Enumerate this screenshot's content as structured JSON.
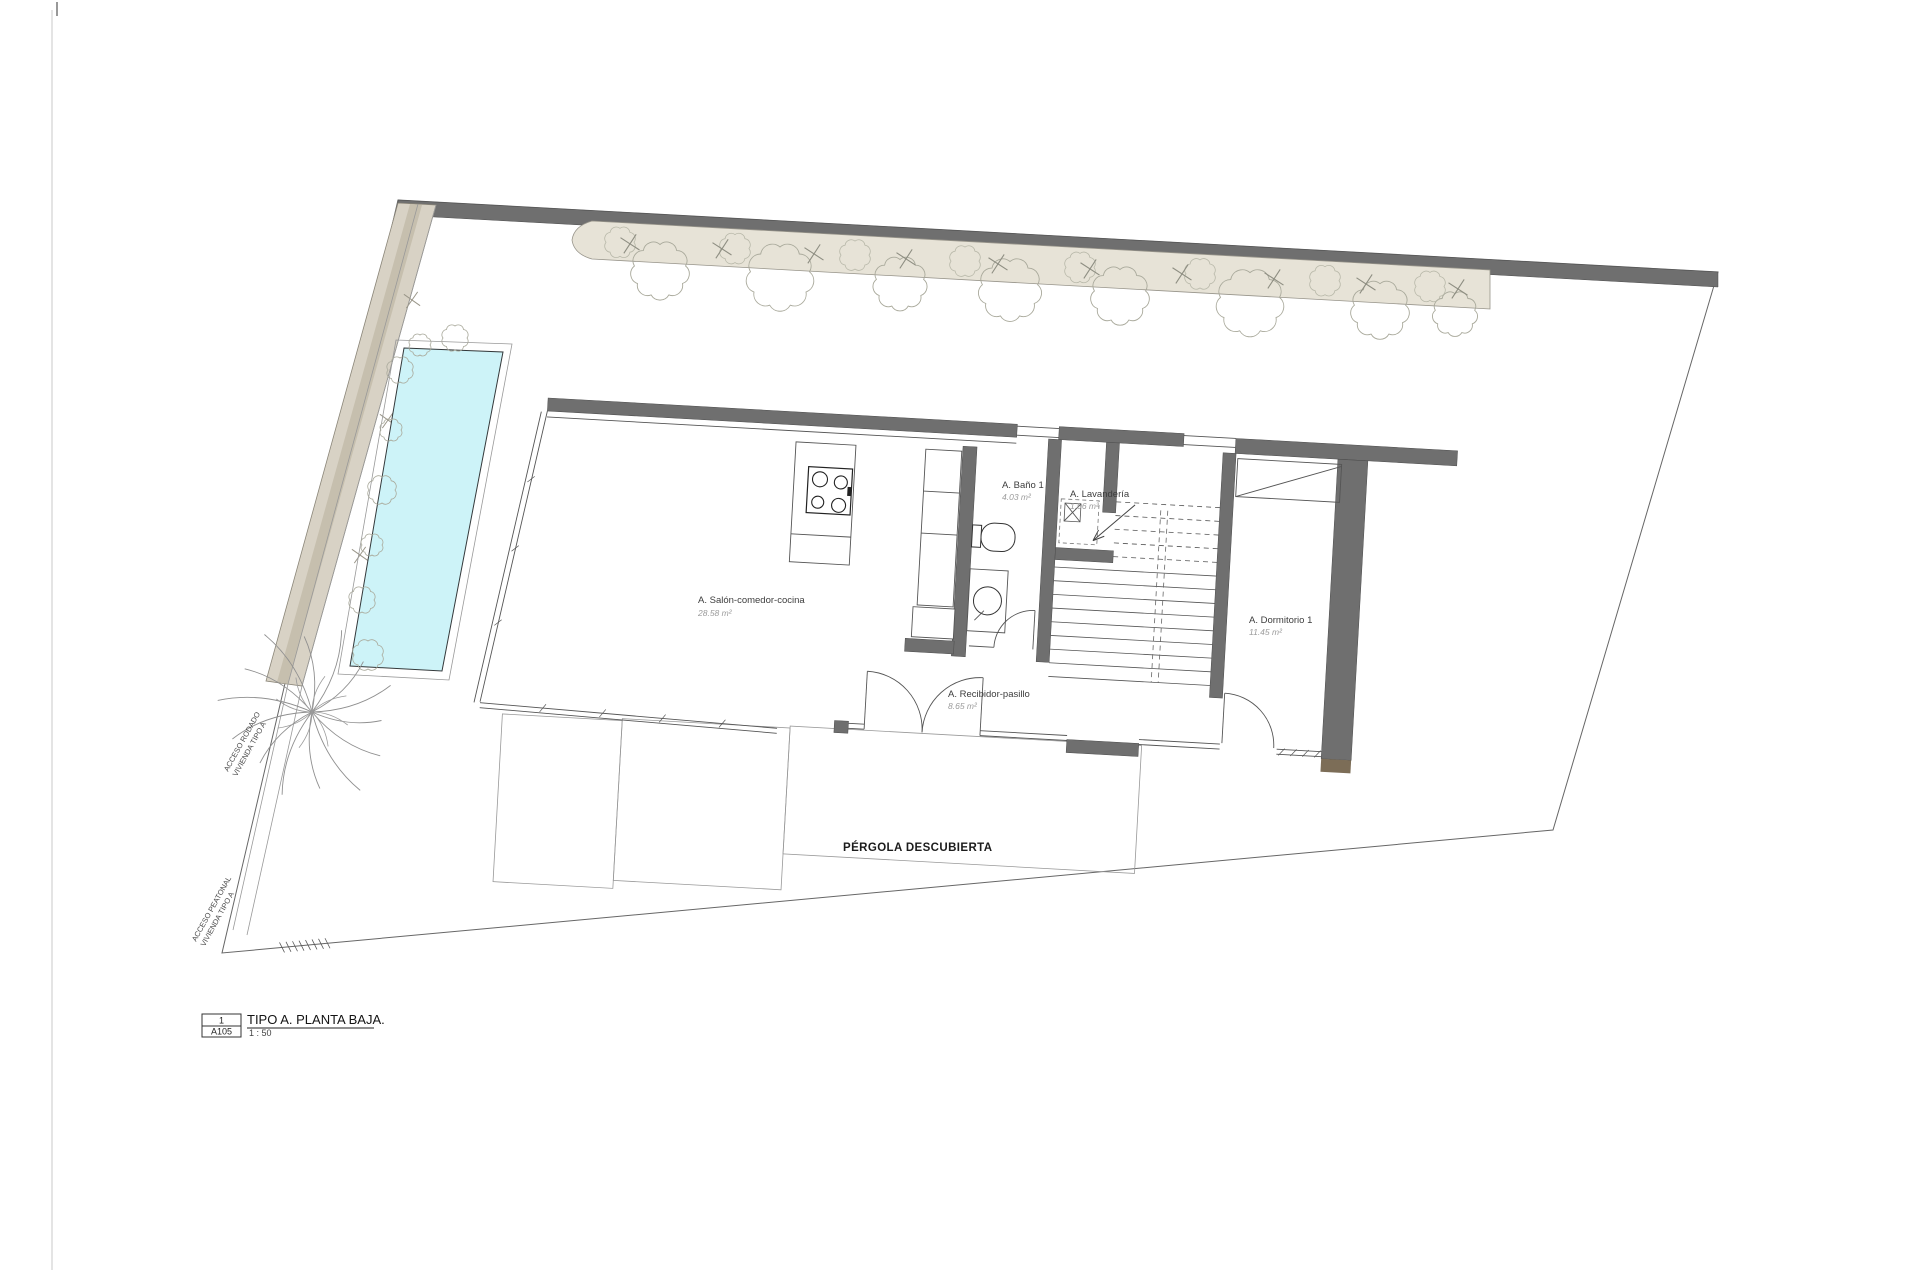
{
  "sheet": {
    "rooms": [
      {
        "name": "A. Salón-comedor-cocina",
        "area": "28.58 m²"
      },
      {
        "name": "A. Baño 1",
        "area": "4.03 m²"
      },
      {
        "name": "A. Lavandería",
        "area": "1.06 m²"
      },
      {
        "name": "A. Dormitorio 1",
        "area": "11.45 m²"
      },
      {
        "name": "A. Recibidor-pasillo",
        "area": "8.65 m²"
      }
    ],
    "pergola_label": "PÉRGOLA DESCUBIERTA",
    "access_road": {
      "line1": "ACCESO RODADO",
      "line2": "VIVIENDA TIPO A"
    },
    "access_pedestrian": {
      "line1": "ACCESO PEATONAL",
      "line2": "VIVIENDA TIPO A"
    },
    "title_block": {
      "detail_number": "1",
      "sheet_number": "A105",
      "title": "TIPO A. PLANTA BAJA.",
      "scale": "1 : 50"
    },
    "colors": {
      "wall": "#6f6f6f",
      "pool": "#cdf3f8",
      "pool_edge": "#33383a",
      "planter": "#e7e3d7",
      "driveway": "#d8d2c5",
      "curb": "#c6bfae",
      "wood_cap": "#7c6d57",
      "vegetation": "#a9a99b"
    }
  }
}
